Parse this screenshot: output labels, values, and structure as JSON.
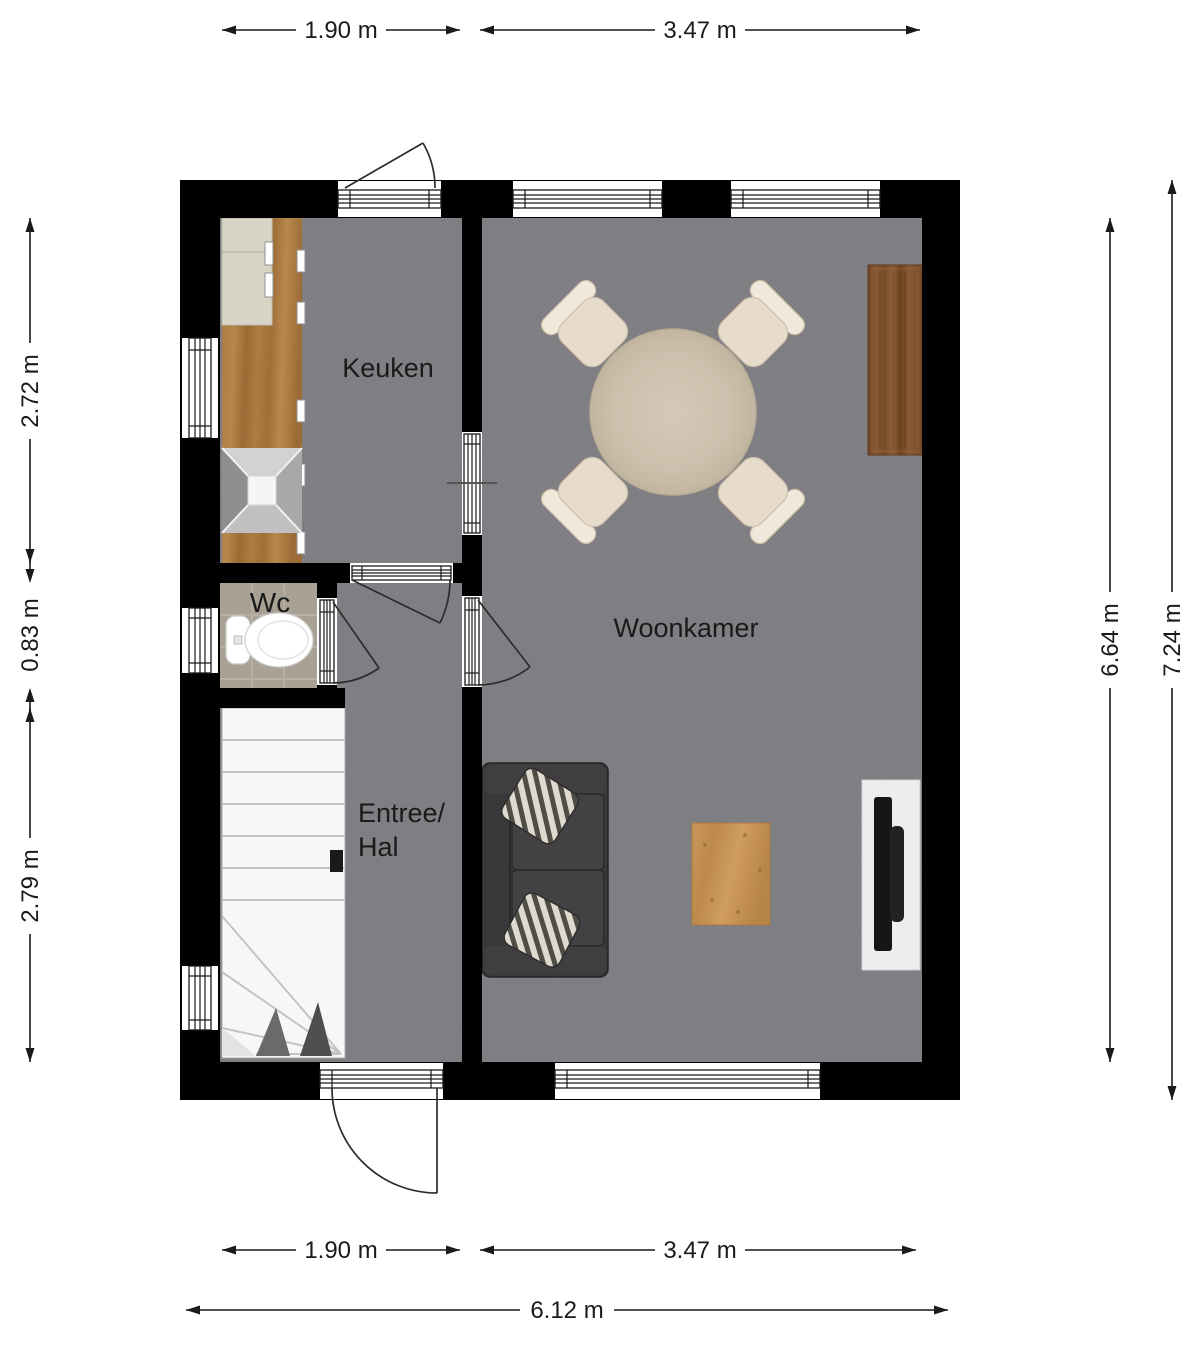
{
  "rooms": {
    "keuken": {
      "label": "Keuken"
    },
    "woonkamer": {
      "label": "Woonkamer"
    },
    "wc": {
      "label": "Wc"
    },
    "entree_hal": {
      "label_line1": "Entree/",
      "label_line2": "Hal"
    }
  },
  "dimensions": {
    "top": [
      {
        "label": "1.90 m"
      },
      {
        "label": "3.47 m"
      }
    ],
    "bottom": [
      {
        "label": "1.90 m"
      },
      {
        "label": "3.47 m"
      },
      {
        "label": "6.12 m"
      }
    ],
    "left": [
      {
        "label": "2.72 m"
      },
      {
        "label": "0.83 m"
      },
      {
        "label": "2.79 m"
      }
    ],
    "right": [
      {
        "label": "6.64 m"
      },
      {
        "label": "7.24 m"
      }
    ]
  },
  "colors": {
    "wall": "#000000",
    "floor": "#98989d",
    "wc_floor": "#a9a294",
    "stairs": "#f7f7f7",
    "counter_wood": "#a8793f",
    "sideboard_wood": "#7d5232",
    "coffee_table_wood": "#c4915a",
    "dining_table": "#ccc0ad",
    "chairs": "#e8ddcc",
    "sofa": "#3a3a3c",
    "tv_cabinet": "#ececec",
    "dimension_text": "#1a1a1a"
  }
}
